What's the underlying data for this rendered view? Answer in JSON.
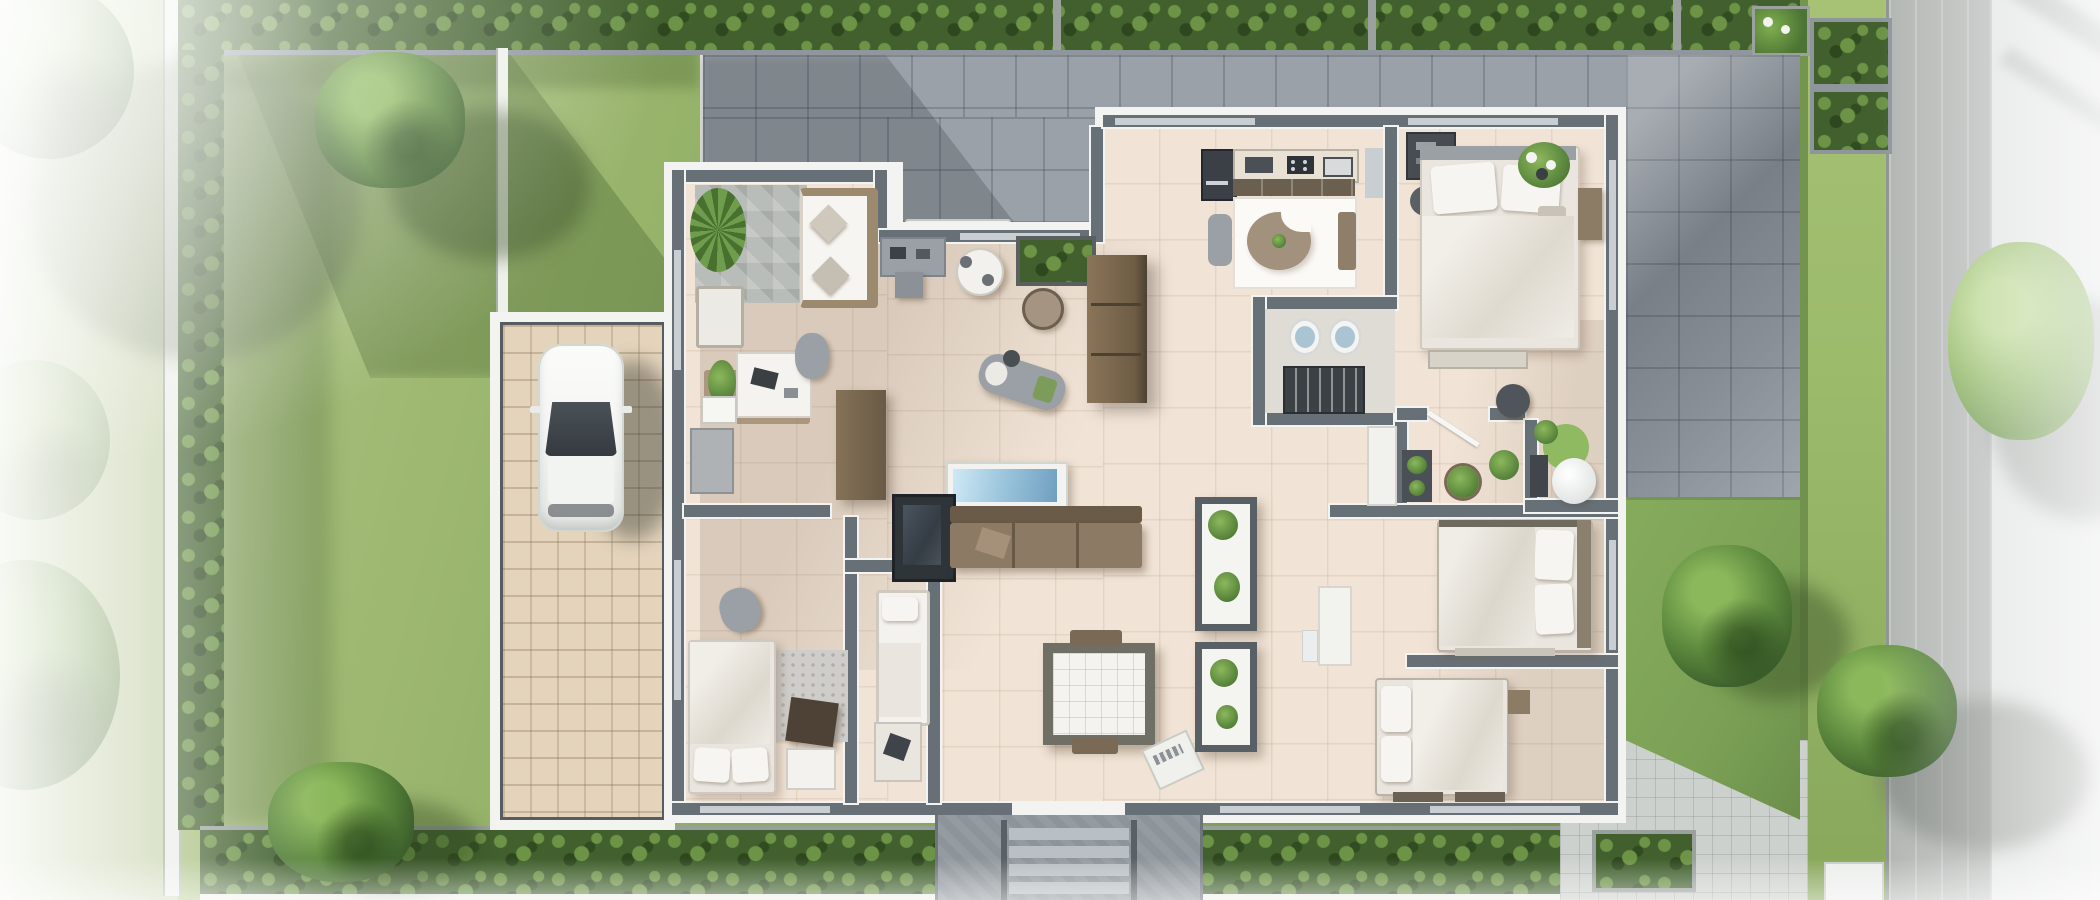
{
  "scene": {
    "type": "aerial-3d-floor-plan-render",
    "description": "Top-down photorealistic rendering of a single-storey house floor plan with furnished rooms, front lawn garden with hedges and trees, paved driveway with a parked white car, grey roof terraces, entrance steps and a street-side walkway",
    "text_content": "none"
  },
  "palette": {
    "lawn": "#8fae62",
    "lawn-light": "#aec383",
    "lawn-dark": "#6d8f4a",
    "lawn-right": "#7ca156",
    "grass-strip": "#9cbb6b",
    "hedge": "#41602d",
    "hedge-hi": "#6c9346",
    "tree-hi": "#8cb85c",
    "tree-mid": "#5d8a3e",
    "tree-dark": "#3d602c",
    "terrace": "#9aa1a8",
    "patio": "#949ba2",
    "plank-path": "#b1b5b2",
    "walkway": "#e0e2e1",
    "pavers": "#cdd1ce",
    "drive-border": "#f3f4f0",
    "drive-frame": "#565c62",
    "drive-tile": "#e4d4bc",
    "outline": "#f3f4f1",
    "wall": "#68707//7",
    "wall_fix": "#687077",
    "window": "#c9ced3",
    "floor": "#f1e4d6",
    "floor-white": "#fbfaf7",
    "stone-mat": "#b9bdb9",
    "entry-pad": "#8d949a",
    "step": "#b9bfc3",
    "car-body": "#f5f6f4",
    "car-glass": "#343a40",
    "wood": "#7d6c57",
    "wood-dark": "#5e4f3d",
    "sofa-brown": "#8d7a64",
    "sofa-back": "#6a5a48",
    "tv-blue-1": "#cfe9f5",
    "tv-blue-2": "#6f9fc0",
    "dark-unit": "#33383d",
    "gray-furn": "#9aa0a5",
    "linen": "#f6f5f1",
    "blanket": "#eae6df",
    "rug-round": "#a2917c",
    "bath-floor": "#dfdcd6",
    "sink-blue": "#aac4d4",
    "wc-rug": "#8fba62"
  },
  "site": {
    "garden": {
      "label": "Front lawn garden"
    },
    "left_boundary": {
      "label": "Left fence line with hedge"
    },
    "top_boundary": {
      "label": "Top hedge planter row"
    },
    "bottom_boundary": {
      "label": "Bottom hedge planter row"
    },
    "garden_wall": {
      "label": "White garden wall"
    },
    "driveway": {
      "label": "Tiled driveway",
      "vehicle_label": "White car parked facing up",
      "vehicle_count": 1
    },
    "terrace": {
      "label": "Grey paved roof terrace (top)"
    },
    "patio_right": {
      "label": "Grey paved patio (right of house)"
    },
    "right_lawn": {
      "label": "Back lawn (right side)"
    },
    "pavers_pad": {
      "label": "Light paver pad (bottom right)"
    },
    "grass_strip": {
      "label": "Grass verge strip"
    },
    "plank_path": {
      "label": "Grey plank path"
    },
    "walkway": {
      "label": "Street-side walkway"
    },
    "entry": {
      "label": "Entrance landing with steps",
      "step_count": 4
    },
    "planters_right": {
      "label": "Raised planter boxes",
      "count": 2
    },
    "trees": {
      "label": "Trees and shrubs",
      "count": 7
    }
  },
  "house": {
    "label": "Single-storey house floor plan",
    "rooms": {
      "office": {
        "label": "Sitting room / home office with palm plant, sofa, bench and desk"
      },
      "hall": {
        "label": "Entry hall and dining area with round table, planter and sideboard"
      },
      "kitchen": {
        "label": "Kitchen with counter, fridge and round dining rug"
      },
      "bedroom_top_right": {
        "label": "Bedroom (top right) with double bed and flower vase"
      },
      "bathroom": {
        "label": "Bathroom with twin basins and shelf unit"
      },
      "wc": {
        "label": "WC with round green rug"
      },
      "living": {
        "label": "Living room with TV wall, brown sofa and square lounge chair"
      },
      "corridor": {
        "label": "Corridor with glazed plant cabinets and console"
      },
      "bedroom_left": {
        "label": "Bedroom (bottom left) with bed, rug and desk"
      },
      "kids_room": {
        "label": "Small bedroom / study (bottom centre)"
      },
      "bedroom_right_upper": {
        "label": "Bedroom (middle right) with double bed"
      },
      "bedroom_right_lower": {
        "label": "Bedroom (bottom right) with double bed and benches"
      }
    }
  }
}
